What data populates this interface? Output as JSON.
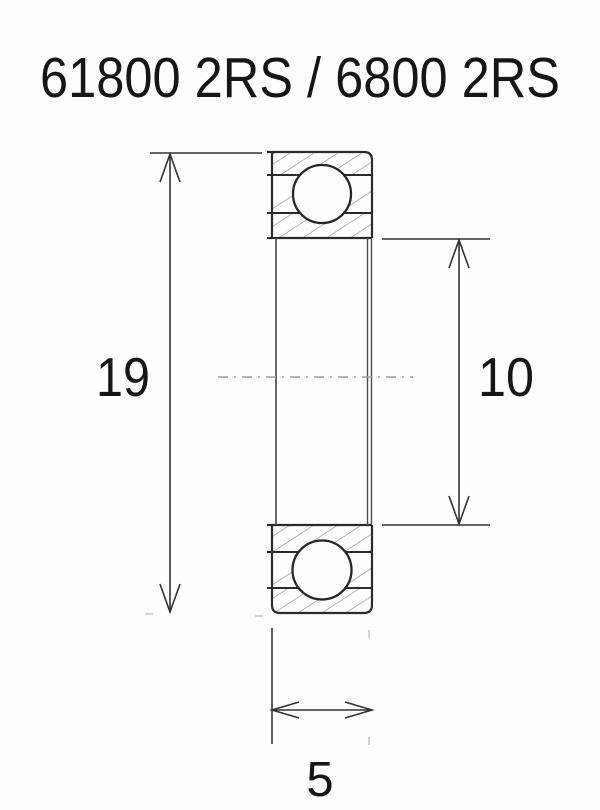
{
  "title": "61800 2RS / 6800 2RS",
  "drawing": {
    "type": "bearing-cross-section",
    "dimensions": {
      "outer_diameter": "19",
      "bore_diameter": "10",
      "width": "5"
    }
  },
  "colors": {
    "background": "#fefefe",
    "outline": "#2b2b2b",
    "dimension_line": "#333333",
    "hatch": "#8f8f8f",
    "centerline": "#9e9e9e",
    "faint_extension": "#b8b8b8",
    "text": "#161616"
  }
}
